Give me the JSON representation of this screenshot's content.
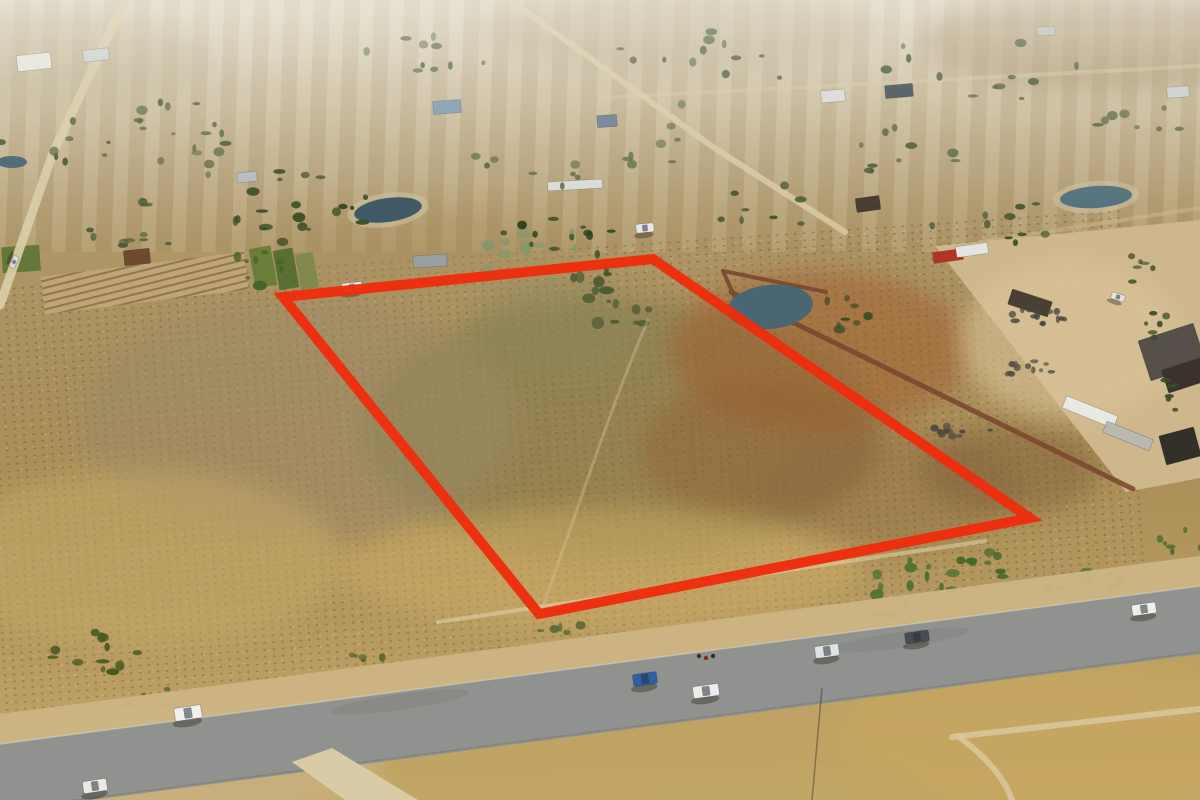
{
  "image": {
    "type": "aerial-drone-photograph",
    "alt": "Aerial drone photo of a vacant dry-veld land parcel outlined in red, surrounded by rural smallholdings, an industrial yard with containers and trucks on the right, and a tar road with parked cars in the foreground"
  },
  "palette": {
    "boundary_red": "#ee2d0d",
    "road_tar": "#90928f",
    "road_dirt": "#d8cba6",
    "sand_yard": "#cfb78d",
    "wall_brown": "#7b4830",
    "pond_water": "#4a6673",
    "tree_dark": "#32431f",
    "tree_green": "#4e6a2e",
    "tree_sage": "#87976b",
    "field_tan": "#b5985f",
    "field_olive": "#7a7444",
    "burnt_orange": "#a05a2c",
    "grass_gold": "#cfae66"
  },
  "boundary": {
    "points": "283,297 653,259 1030,518 539,614",
    "stroke_width": 10
  },
  "ponds": [
    {
      "x": 388,
      "y": 210,
      "rx": 34,
      "ry": 12,
      "rot": -8,
      "water": "#3f5966",
      "shore": true
    },
    {
      "x": 770,
      "y": 307,
      "rx": 43,
      "ry": 22,
      "rot": -6,
      "water": "#4a6673",
      "shore": false
    },
    {
      "x": 1096,
      "y": 197,
      "rx": 36,
      "ry": 11,
      "rot": -4,
      "water": "#55737e",
      "shore": true
    },
    {
      "x": 12,
      "y": 162,
      "rx": 15,
      "ry": 6,
      "rot": 0,
      "water": "#4a6472",
      "shore": false
    }
  ],
  "buildings": [
    {
      "x": 34,
      "y": 62,
      "w": 34,
      "h": 16,
      "rot": -6,
      "fill": "#e9e7e0"
    },
    {
      "x": 96,
      "y": 55,
      "w": 26,
      "h": 12,
      "rot": -6,
      "fill": "#ced3d5"
    },
    {
      "x": 447,
      "y": 107,
      "w": 28,
      "h": 13,
      "rot": -4,
      "fill": "#7f9db4"
    },
    {
      "x": 607,
      "y": 121,
      "w": 20,
      "h": 12,
      "rot": -4,
      "fill": "#6b7f94"
    },
    {
      "x": 833,
      "y": 96,
      "w": 24,
      "h": 12,
      "rot": -5,
      "fill": "#dadcda"
    },
    {
      "x": 899,
      "y": 91,
      "w": 28,
      "h": 13,
      "rot": -5,
      "fill": "#404b56"
    },
    {
      "x": 868,
      "y": 204,
      "w": 24,
      "h": 14,
      "rot": -8,
      "fill": "#4a3c30"
    },
    {
      "x": 137,
      "y": 257,
      "w": 26,
      "h": 15,
      "rot": -6,
      "fill": "#6e4a2e"
    },
    {
      "x": 575,
      "y": 185,
      "w": 55,
      "h": 9,
      "rot": -3,
      "fill": "#d9dcd8"
    },
    {
      "x": 430,
      "y": 261,
      "w": 34,
      "h": 12,
      "rot": -4,
      "fill": "#9aa0a2"
    },
    {
      "x": 247,
      "y": 177,
      "w": 20,
      "h": 10,
      "rot": -5,
      "fill": "#b7bcc0"
    },
    {
      "x": 1178,
      "y": 92,
      "w": 22,
      "h": 11,
      "rot": -4,
      "fill": "#ccd0cf"
    },
    {
      "x": 1046,
      "y": 31,
      "w": 18,
      "h": 9,
      "rot": -3,
      "fill": "#b9beb9"
    },
    {
      "x": 948,
      "y": 256,
      "w": 30,
      "h": 11,
      "rot": -8,
      "fill": "#b23327"
    },
    {
      "x": 972,
      "y": 250,
      "w": 32,
      "h": 11,
      "rot": -8,
      "fill": "#e4e4e0"
    },
    {
      "x": 1030,
      "y": 303,
      "w": 42,
      "h": 16,
      "rot": 18,
      "fill": "#4a3f33"
    },
    {
      "x": 1090,
      "y": 412,
      "w": 55,
      "h": 13,
      "rot": 22,
      "fill": "#e8e8e4"
    },
    {
      "x": 1128,
      "y": 436,
      "w": 50,
      "h": 12,
      "rot": 22,
      "fill": "#b9b9b2"
    },
    {
      "x": 1172,
      "y": 352,
      "w": 58,
      "h": 42,
      "rot": -18,
      "fill": "#57504a"
    },
    {
      "x": 1186,
      "y": 375,
      "w": 44,
      "h": 24,
      "rot": -18,
      "fill": "#3a332c"
    },
    {
      "x": 1180,
      "y": 446,
      "w": 36,
      "h": 30,
      "rot": -15,
      "fill": "#332f29"
    }
  ],
  "fields": [
    {
      "x": 252,
      "y": 247,
      "w": 22,
      "h": 40,
      "rot": -10,
      "fill": "#5f7a33"
    },
    {
      "x": 276,
      "y": 249,
      "w": 20,
      "h": 40,
      "rot": -10,
      "fill": "#4b6a2a"
    },
    {
      "x": 298,
      "y": 253,
      "w": 18,
      "h": 36,
      "rot": -10,
      "fill": "#79874a"
    },
    {
      "x": 2,
      "y": 246,
      "w": 38,
      "h": 26,
      "rot": -4,
      "fill": "#587231"
    }
  ],
  "vehicles": [
    {
      "x": 188,
      "y": 713,
      "w": 27,
      "h": 13,
      "rot": -9,
      "body": "#f1f1ee"
    },
    {
      "x": 95,
      "y": 786,
      "w": 24,
      "h": 12,
      "rot": -9,
      "body": "#e9e9e5"
    },
    {
      "x": 645,
      "y": 679,
      "w": 24,
      "h": 12,
      "rot": -8,
      "body": "#2e5fa3"
    },
    {
      "x": 706,
      "y": 691,
      "w": 26,
      "h": 12,
      "rot": -8,
      "body": "#ececea"
    },
    {
      "x": 827,
      "y": 651,
      "w": 24,
      "h": 12,
      "rot": -8,
      "body": "#e0e3e3"
    },
    {
      "x": 917,
      "y": 637,
      "w": 24,
      "h": 11,
      "rot": -8,
      "body": "#474d52"
    },
    {
      "x": 1144,
      "y": 609,
      "w": 24,
      "h": 11,
      "rot": -8,
      "body": "#edefed"
    },
    {
      "x": 352,
      "y": 287,
      "w": 20,
      "h": 9,
      "rot": -6,
      "body": "#eef0ee"
    },
    {
      "x": 645,
      "y": 228,
      "w": 18,
      "h": 9,
      "rot": -6,
      "body": "#e6e8e6"
    },
    {
      "x": 14,
      "y": 262,
      "w": 13,
      "h": 6,
      "rot": 115,
      "body": "#d9d9d5"
    },
    {
      "x": 1118,
      "y": 297,
      "w": 14,
      "h": 7,
      "rot": 18,
      "body": "#e2e3df"
    }
  ],
  "people": [
    {
      "x": 699,
      "y": 656,
      "c": "#3a332b"
    },
    {
      "x": 706,
      "y": 658,
      "c": "#7a2d20"
    },
    {
      "x": 713,
      "y": 656,
      "c": "#2f2f33"
    }
  ],
  "scatter_clusters": [
    {
      "x": 300,
      "y": 205,
      "rx": 75,
      "ry": 38,
      "n": 20,
      "s": 5,
      "fill": "#3a4c26"
    },
    {
      "x": 548,
      "y": 262,
      "rx": 70,
      "ry": 40,
      "n": 22,
      "s": 6,
      "fill": "#87976b"
    },
    {
      "x": 612,
      "y": 300,
      "rx": 55,
      "ry": 32,
      "n": 16,
      "s": 6,
      "fill": "#49582f"
    },
    {
      "x": 560,
      "y": 238,
      "rx": 60,
      "ry": 22,
      "n": 12,
      "s": 4,
      "fill": "#32431f"
    },
    {
      "x": 648,
      "y": 130,
      "rx": 40,
      "ry": 50,
      "n": 8,
      "s": 4,
      "fill": "#65724a"
    },
    {
      "x": 905,
      "y": 588,
      "rx": 58,
      "ry": 30,
      "n": 16,
      "s": 5,
      "fill": "#4c7030"
    },
    {
      "x": 1085,
      "y": 594,
      "rx": 48,
      "ry": 26,
      "n": 12,
      "s": 5,
      "fill": "#537734"
    },
    {
      "x": 985,
      "y": 570,
      "rx": 35,
      "ry": 20,
      "n": 8,
      "s": 4,
      "fill": "#47682c"
    },
    {
      "x": 95,
      "y": 652,
      "rx": 48,
      "ry": 26,
      "n": 12,
      "s": 5,
      "fill": "#44561f"
    },
    {
      "x": 60,
      "y": 138,
      "rx": 60,
      "ry": 26,
      "n": 8,
      "s": 4,
      "fill": "#4a5a33"
    },
    {
      "x": 205,
      "y": 118,
      "rx": 70,
      "ry": 28,
      "n": 10,
      "s": 4,
      "fill": "#53643a"
    },
    {
      "x": 430,
      "y": 62,
      "rx": 80,
      "ry": 28,
      "n": 10,
      "s": 4,
      "fill": "#5b6b41"
    },
    {
      "x": 705,
      "y": 60,
      "rx": 95,
      "ry": 32,
      "n": 12,
      "s": 4,
      "fill": "#4e5f38"
    },
    {
      "x": 985,
      "y": 68,
      "rx": 105,
      "ry": 38,
      "n": 12,
      "s": 4,
      "fill": "#465734"
    },
    {
      "x": 1125,
      "y": 122,
      "rx": 70,
      "ry": 28,
      "n": 8,
      "s": 4,
      "fill": "#515f3a"
    },
    {
      "x": 880,
      "y": 148,
      "rx": 85,
      "ry": 30,
      "n": 10,
      "s": 4,
      "fill": "#4d5d38"
    },
    {
      "x": 520,
      "y": 168,
      "rx": 65,
      "ry": 24,
      "n": 8,
      "s": 4,
      "fill": "#5a6a42"
    },
    {
      "x": 765,
      "y": 208,
      "rx": 60,
      "ry": 24,
      "n": 8,
      "s": 4,
      "fill": "#42532e"
    },
    {
      "x": 1005,
      "y": 222,
      "rx": 95,
      "ry": 22,
      "n": 10,
      "s": 4,
      "fill": "#3f512c"
    },
    {
      "x": 140,
      "y": 228,
      "rx": 60,
      "ry": 26,
      "n": 10,
      "s": 4,
      "fill": "#4f5f38"
    },
    {
      "x": 190,
      "y": 160,
      "rx": 40,
      "ry": 30,
      "n": 8,
      "s": 4,
      "fill": "#6a6f49"
    },
    {
      "x": 845,
      "y": 315,
      "rx": 30,
      "ry": 22,
      "n": 8,
      "s": 4,
      "fill": "#3c4d26"
    },
    {
      "x": 255,
      "y": 268,
      "rx": 35,
      "ry": 18,
      "n": 8,
      "s": 5,
      "fill": "#45622c"
    },
    {
      "x": 150,
      "y": 700,
      "rx": 30,
      "ry": 14,
      "n": 6,
      "s": 4,
      "fill": "#55622e"
    },
    {
      "x": 360,
      "y": 662,
      "rx": 26,
      "ry": 12,
      "n": 5,
      "s": 4,
      "fill": "#5d6a33"
    },
    {
      "x": 565,
      "y": 632,
      "rx": 26,
      "ry": 12,
      "n": 5,
      "s": 4,
      "fill": "#566532"
    },
    {
      "x": 1185,
      "y": 542,
      "rx": 28,
      "ry": 15,
      "n": 6,
      "s": 4,
      "fill": "#4a6a2e"
    },
    {
      "x": 1140,
      "y": 270,
      "rx": 14,
      "ry": 18,
      "n": 6,
      "s": 3,
      "fill": "#3d4d2a"
    },
    {
      "x": 1158,
      "y": 330,
      "rx": 14,
      "ry": 20,
      "n": 6,
      "s": 3,
      "fill": "#3d4d2a"
    },
    {
      "x": 1175,
      "y": 392,
      "rx": 14,
      "ry": 20,
      "n": 6,
      "s": 3,
      "fill": "#3d4d2a"
    },
    {
      "x": 1032,
      "y": 316,
      "rx": 40,
      "ry": 8,
      "n": 14,
      "s": 3,
      "fill": "#4a463e"
    },
    {
      "x": 1022,
      "y": 368,
      "rx": 35,
      "ry": 8,
      "n": 12,
      "s": 3,
      "fill": "#56524a"
    },
    {
      "x": 962,
      "y": 430,
      "rx": 30,
      "ry": 7,
      "n": 10,
      "s": 3,
      "fill": "#4a463e"
    }
  ]
}
